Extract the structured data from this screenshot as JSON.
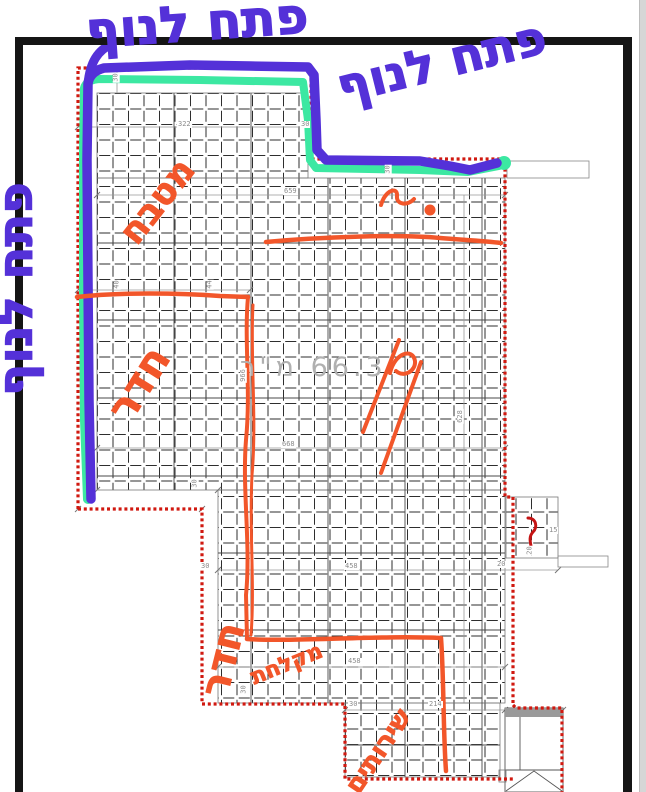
{
  "page": {
    "background": "#ffffff",
    "frame_color": "#151515"
  },
  "colors": {
    "marker_blue": "#5431d8",
    "highlighter_green": "#3ce8a2",
    "marker_orange": "#f2562a",
    "boundary_red": "#d01910",
    "pen_red": "#c41414",
    "tile_line": "#2e2e2e",
    "dimension_text": "#8c8c8c",
    "area_text": "#b0b0b0"
  },
  "plan": {
    "area_label": "66.3 מ\"ר",
    "dimension_labels": [
      {
        "text": "30",
        "x": 111,
        "y": 74,
        "rot": true
      },
      {
        "text": "322",
        "x": 177,
        "y": 121
      },
      {
        "text": "30",
        "x": 300,
        "y": 121
      },
      {
        "text": "659",
        "x": 283,
        "y": 188
      },
      {
        "text": "30",
        "x": 383,
        "y": 166,
        "rot": true
      },
      {
        "text": "40",
        "x": 112,
        "y": 281,
        "rot": true
      },
      {
        "text": "44",
        "x": 205,
        "y": 281,
        "rot": true
      },
      {
        "text": "966",
        "x": 236,
        "y": 372,
        "rot": true
      },
      {
        "text": "628",
        "x": 453,
        "y": 413,
        "rot": true
      },
      {
        "text": "668",
        "x": 281,
        "y": 441
      },
      {
        "text": "30",
        "x": 190,
        "y": 480,
        "rot": true
      },
      {
        "text": "30",
        "x": 200,
        "y": 563
      },
      {
        "text": "458",
        "x": 344,
        "y": 563
      },
      {
        "text": "458",
        "x": 347,
        "y": 658
      },
      {
        "text": "30",
        "x": 239,
        "y": 686,
        "rot": true
      },
      {
        "text": "30",
        "x": 348,
        "y": 701
      },
      {
        "text": "214",
        "x": 428,
        "y": 701
      },
      {
        "text": "15",
        "x": 548,
        "y": 527
      },
      {
        "text": "20",
        "x": 525,
        "y": 547,
        "rot": true
      },
      {
        "text": "20",
        "x": 496,
        "y": 561
      }
    ],
    "handwriting": [
      {
        "id": "view-note-top-left",
        "text": "פתח לנוף",
        "color": "blue",
        "x": 86,
        "y": 6,
        "size": 50,
        "rot": -4
      },
      {
        "id": "view-note-top-right",
        "text": "פתח לנוף",
        "color": "blue",
        "x": 338,
        "y": 64,
        "size": 48,
        "rot": -14
      },
      {
        "id": "view-note-left",
        "text": "פתח לנוף",
        "color": "blue",
        "x": 16,
        "y": 372,
        "size": 48,
        "rot": -90
      },
      {
        "id": "kitchen",
        "text": "מטבח",
        "color": "orange",
        "x": 128,
        "y": 222,
        "size": 36,
        "rot": -52
      },
      {
        "id": "room-1",
        "text": "חדר",
        "color": "orange",
        "x": 118,
        "y": 396,
        "size": 42,
        "rot": -58
      },
      {
        "id": "room-2",
        "text": "חדר",
        "color": "orange",
        "x": 214,
        "y": 676,
        "size": 40,
        "rot": -76
      },
      {
        "id": "shower",
        "text": "מקלחת",
        "color": "orange",
        "x": 252,
        "y": 668,
        "size": 22,
        "rot": -22
      },
      {
        "id": "toilets",
        "text": "שירותים",
        "color": "orange",
        "x": 352,
        "y": 778,
        "size": 26,
        "rot": -56
      }
    ]
  }
}
